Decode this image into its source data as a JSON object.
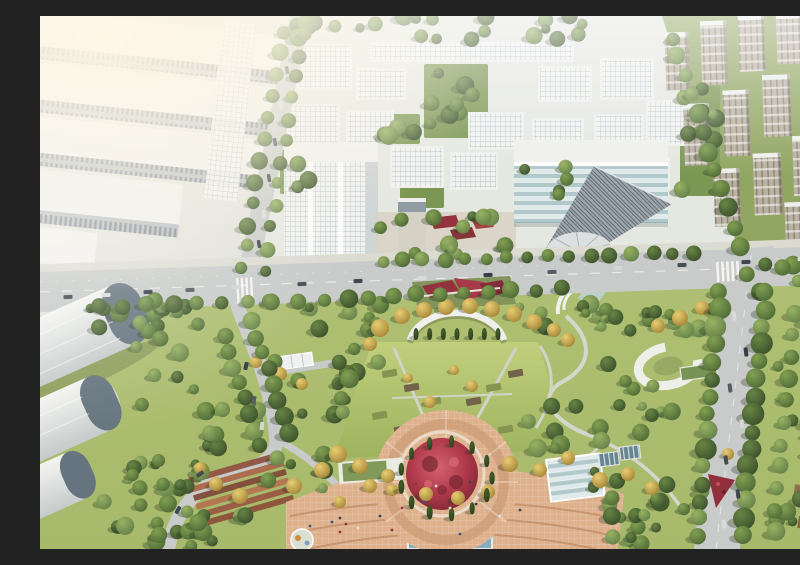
{
  "scene": {
    "title": "Aerial rendering of a technology campus and central park",
    "description": "Bird's-eye architectural rendering: white industrial halls upper-left, a white office campus with green courtyards top-center, dense high-rise residential towers top-right, a tree-lined boulevard crossing the middle with traffic, and a large landscaped park below with golden tree arcs, a circular red flower garden ringed by conifers, terracotta plazas, winding paths, barrel-roof hangars lower-left and a tree-lined avenue on the right.",
    "regions": [
      "industrial-halls",
      "office-campus",
      "residential-towers",
      "main-boulevard",
      "central-park",
      "flower-plaza",
      "hangars",
      "avenue"
    ]
  },
  "palette": {
    "roofWhite": "#eef0ee",
    "campusWall": "#f0f3f3",
    "gridLine": "#b4bec6",
    "courtGreen": "#74924c",
    "towerTan": "#b5aea0",
    "towerLine": "#857f70",
    "road": "#c5c9c9",
    "roadSide": "#d9dad3",
    "laneLine": "#f2f2ee",
    "glass1": "#dfeaec",
    "glass2": "#aec7cc",
    "hatchBg": "#97a2ab",
    "hatchLine": "#4e5a64",
    "hangarEnd": "#5c6d7a",
    "plazaPave": "#dcae8a",
    "pavingLine": "#c4906a",
    "redPavilion": "#8e2736",
    "flowerRed": "#aa2e42",
    "poolBlue": "#7fa9bc",
    "lawnLight": "#becd78",
    "lawnDark": "#97b058",
    "groundTop": "#ccd4b4",
    "groundBottom": "#a2b665",
    "industrialGround": "#e0e1dc",
    "campusGround": "#e4e7e3",
    "residentialGround": "#8ba25c"
  },
  "campus": {
    "blocks": [
      [
        250,
        28,
        62,
        46
      ],
      [
        330,
        26,
        204,
        20
      ],
      [
        316,
        52,
        50,
        32
      ],
      [
        498,
        50,
        54,
        36
      ],
      [
        560,
        42,
        54,
        42
      ],
      [
        246,
        88,
        54,
        42
      ],
      [
        306,
        94,
        48,
        34
      ],
      [
        428,
        96,
        56,
        38
      ],
      [
        492,
        102,
        52,
        36
      ],
      [
        554,
        98,
        50,
        40
      ],
      [
        606,
        84,
        42,
        46
      ],
      [
        350,
        130,
        54,
        42
      ],
      [
        410,
        136,
        48,
        38
      ],
      [
        590,
        142,
        40,
        32
      ]
    ],
    "courtyards": [
      [
        384,
        48,
        64,
        74
      ],
      [
        342,
        98,
        38,
        30
      ],
      [
        478,
        140,
        56,
        44
      ],
      [
        640,
        70,
        40,
        110
      ],
      [
        240,
        134,
        40,
        44
      ],
      [
        360,
        166,
        44,
        26
      ]
    ]
  },
  "residential": {
    "towers": [
      [
        628,
        14,
        24,
        58
      ],
      [
        664,
        4,
        26,
        64
      ],
      [
        702,
        0,
        26,
        56
      ],
      [
        740,
        0,
        26,
        50
      ],
      [
        774,
        0,
        24,
        46
      ],
      [
        644,
        86,
        26,
        62
      ],
      [
        684,
        74,
        26,
        66
      ],
      [
        724,
        60,
        28,
        62
      ],
      [
        764,
        48,
        28,
        58
      ],
      [
        672,
        152,
        26,
        58
      ],
      [
        712,
        138,
        28,
        62
      ],
      [
        752,
        122,
        28,
        60
      ],
      [
        788,
        112,
        12,
        56
      ],
      [
        742,
        188,
        26,
        44
      ],
      [
        782,
        176,
        18,
        48
      ]
    ]
  },
  "park": {
    "tree_bands": [
      [
        250,
        0,
        372,
        24,
        24
      ],
      [
        388,
        52,
        56,
        66,
        8
      ],
      [
        344,
        100,
        34,
        26,
        4
      ],
      [
        480,
        142,
        50,
        38,
        5
      ],
      [
        642,
        72,
        36,
        106,
        9
      ],
      [
        242,
        136,
        36,
        40,
        4
      ],
      [
        338,
        198,
        132,
        16,
        7
      ],
      [
        338,
        228,
        132,
        12,
        6
      ],
      [
        50,
        284,
        312,
        32,
        26
      ],
      [
        476,
        284,
        200,
        32,
        17
      ],
      [
        95,
        304,
        70,
        226,
        20
      ],
      [
        60,
        440,
        120,
        90,
        13
      ],
      [
        210,
        336,
        112,
        96,
        13
      ],
      [
        552,
        292,
        92,
        238,
        24
      ],
      [
        736,
        280,
        64,
        250,
        18
      ],
      [
        60,
        498,
        170,
        32,
        9
      ],
      [
        556,
        470,
        124,
        58,
        11
      ],
      [
        480,
        380,
        84,
        58,
        9
      ],
      [
        228,
        428,
        84,
        62,
        8
      ],
      [
        700,
        240,
        96,
        36,
        7
      ],
      [
        160,
        380,
        60,
        60,
        6
      ],
      [
        296,
        332,
        52,
        36,
        5
      ]
    ],
    "tree_rows": [
      [
        58,
        291,
        308,
        283,
        11,
        7.5
      ],
      [
        330,
        281,
        520,
        273,
        9,
        7
      ],
      [
        342,
        245,
        654,
        236,
        16,
        6.5
      ],
      [
        242,
        16,
        202,
        252,
        12,
        7
      ],
      [
        264,
        18,
        224,
        254,
        12,
        6.5
      ],
      [
        680,
        276,
        656,
        520,
        15,
        9
      ],
      [
        726,
        276,
        702,
        520,
        15,
        9
      ],
      [
        754,
        298,
        734,
        516,
        11,
        8
      ],
      [
        632,
        22,
        700,
        230,
        12,
        8
      ],
      [
        184,
        320,
        220,
        430,
        8,
        7.5
      ],
      [
        212,
        306,
        250,
        416,
        8,
        8
      ]
    ],
    "gold_trees": [
      [
        340,
        312,
        9
      ],
      [
        362,
        300,
        8
      ],
      [
        384,
        294,
        8
      ],
      [
        406,
        291,
        8
      ],
      [
        430,
        290,
        8
      ],
      [
        452,
        293,
        8
      ],
      [
        474,
        298,
        8
      ],
      [
        494,
        306,
        8
      ],
      [
        514,
        314,
        7
      ],
      [
        330,
        328,
        7
      ],
      [
        528,
        324,
        7
      ],
      [
        240,
        358,
        7
      ],
      [
        216,
        346,
        6
      ],
      [
        262,
        368,
        6
      ],
      [
        390,
        386,
        6
      ],
      [
        432,
        370,
        6
      ],
      [
        414,
        354,
        5
      ],
      [
        368,
        362,
        5
      ],
      [
        298,
        438,
        9
      ],
      [
        320,
        450,
        8
      ],
      [
        282,
        454,
        8
      ],
      [
        348,
        460,
        7
      ],
      [
        470,
        448,
        8
      ],
      [
        500,
        454,
        7
      ],
      [
        528,
        442,
        7
      ],
      [
        254,
        470,
        8
      ],
      [
        560,
        464,
        8
      ],
      [
        588,
        458,
        7
      ],
      [
        612,
        472,
        7
      ],
      [
        200,
        480,
        8
      ],
      [
        176,
        468,
        7
      ],
      [
        160,
        452,
        6
      ],
      [
        330,
        470,
        7
      ],
      [
        352,
        474,
        6
      ],
      [
        386,
        478,
        7
      ],
      [
        418,
        482,
        7
      ],
      [
        448,
        476,
        7
      ],
      [
        300,
        486,
        6
      ],
      [
        640,
        302,
        8
      ],
      [
        662,
        292,
        7
      ],
      [
        618,
        310,
        7
      ],
      [
        688,
        438,
        6
      ],
      [
        706,
        470,
        6
      ]
    ],
    "conifer_ring": {
      "cx": 406,
      "cy": 462,
      "r": 46,
      "n": 13,
      "size": 6
    },
    "conifer_row": {
      "x1": 376,
      "y1": 318,
      "x2": 458,
      "y2": 318,
      "n": 7,
      "size": 6
    },
    "beds": [
      [
        342,
        354
      ],
      [
        364,
        368
      ],
      [
        386,
        382
      ],
      [
        406,
        396
      ],
      [
        332,
        396
      ],
      [
        354,
        410
      ],
      [
        376,
        424
      ],
      [
        468,
        354
      ],
      [
        446,
        368
      ],
      [
        426,
        382
      ],
      [
        458,
        410
      ],
      [
        436,
        424
      ]
    ],
    "bed_colors": [
      "#7e8f4a",
      "#6b5b43"
    ],
    "terrace_colors": [
      "#8a4a38",
      "#a55f41",
      "#7a4030",
      "#b06b4a",
      "#94503a",
      "#86472f"
    ]
  },
  "traffic": {
    "colors": [
      "#343b45",
      "#d8dadb",
      "#2b323c",
      "#4a545e",
      "#d2d5d6",
      "#39424d"
    ],
    "ew": [
      [
        28,
        281
      ],
      [
        66,
        279
      ],
      [
        108,
        276
      ],
      [
        150,
        274
      ],
      [
        196,
        271
      ],
      [
        262,
        268
      ],
      [
        318,
        265
      ],
      [
        382,
        262
      ],
      [
        448,
        259
      ],
      [
        512,
        256
      ],
      [
        578,
        252
      ],
      [
        642,
        249
      ],
      [
        706,
        246
      ],
      [
        762,
        243
      ]
    ],
    "ns": [
      [
        694,
        300
      ],
      [
        706,
        336
      ],
      [
        690,
        372
      ],
      [
        702,
        408
      ],
      [
        686,
        444
      ],
      [
        698,
        478
      ],
      [
        684,
        508
      ]
    ],
    "park": [
      [
        206,
        350,
        -78
      ],
      [
        214,
        384,
        -80
      ],
      [
        222,
        410,
        -84
      ],
      [
        160,
        458,
        -35
      ],
      [
        138,
        494,
        -60
      ]
    ],
    "parked": [
      [
        247,
        54
      ],
      [
        241,
        90
      ],
      [
        235,
        126
      ],
      [
        229,
        162
      ],
      [
        224,
        198
      ],
      [
        219,
        228
      ]
    ]
  },
  "people": {
    "colors": [
      "#33383f",
      "#8a2b2b",
      "#2b4a8a",
      "#e5e1d8"
    ],
    "points": [
      [
        300,
        502
      ],
      [
        306,
        508
      ],
      [
        292,
        506
      ],
      [
        318,
        512
      ],
      [
        340,
        500
      ],
      [
        362,
        492
      ],
      [
        384,
        486
      ],
      [
        410,
        492
      ],
      [
        436,
        488
      ],
      [
        300,
        516
      ],
      [
        270,
        510
      ],
      [
        460,
        500
      ],
      [
        480,
        494
      ],
      [
        352,
        514
      ],
      [
        420,
        518
      ],
      [
        396,
        470
      ],
      [
        430,
        466
      ],
      [
        376,
        468
      ]
    ]
  }
}
